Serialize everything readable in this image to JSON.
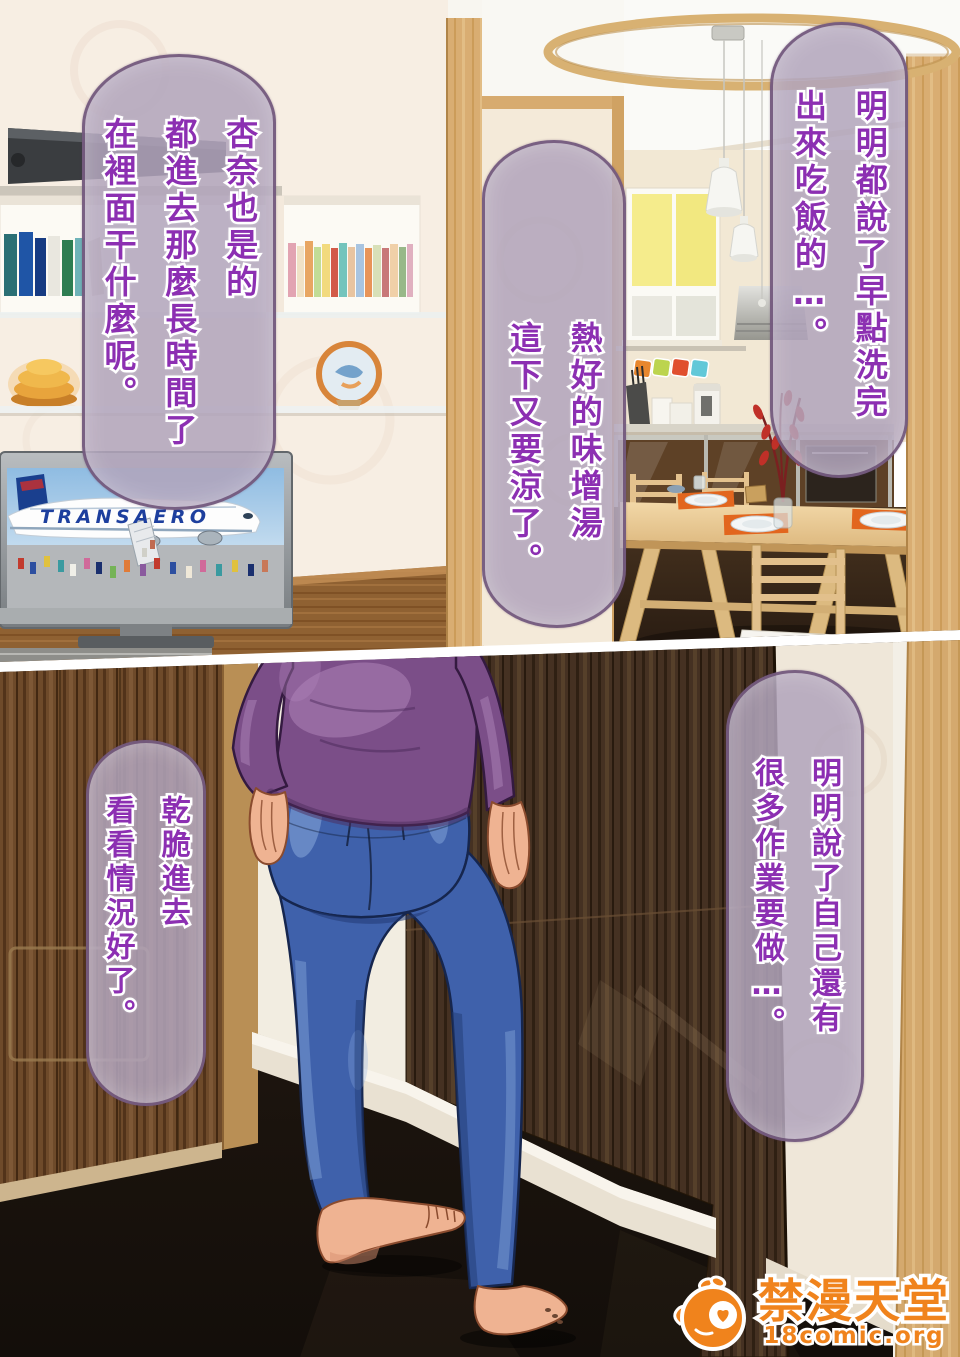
{
  "page_type": "comic-page",
  "bubbles": [
    {
      "id": "top-right",
      "text": "明明都說了早點洗完\n出來吃飯的…。"
    },
    {
      "id": "top-middle",
      "text": "熱好的味增湯\n這下又要涼了。"
    },
    {
      "id": "top-left",
      "text": "杏奈也是的\n都進去那麼長時間了\n在裡面干什麼呢。"
    },
    {
      "id": "bottom-right",
      "text": "明明說了自己還有\n很多作業要做…。"
    },
    {
      "id": "bottom-left",
      "text": "乾脆進去\n看看情況好了。"
    }
  ],
  "tv": {
    "airline_text": "TRANSAERO"
  },
  "watermark": {
    "site_name": "禁漫天堂",
    "site_url": "18comic.org"
  },
  "colors": {
    "bubble_fill": "#b1a4bb",
    "bubble_border": "#63466e",
    "bubble_text": "#8c2fb2",
    "watermark_orange": "#f0831c",
    "sweater_purple": "#7b4e88",
    "jeans_blue": "#3f61ab",
    "skin": "#efb392",
    "door_brown": "#453122",
    "wood_tan": "#d9ad72",
    "floor_dark": "#1d1510",
    "wall_cream": "#f7eee3",
    "window_yellow": "#f5ec8c",
    "placemat_orange": "#e2661e",
    "tv_airline_blue": "#1d3f9e"
  }
}
